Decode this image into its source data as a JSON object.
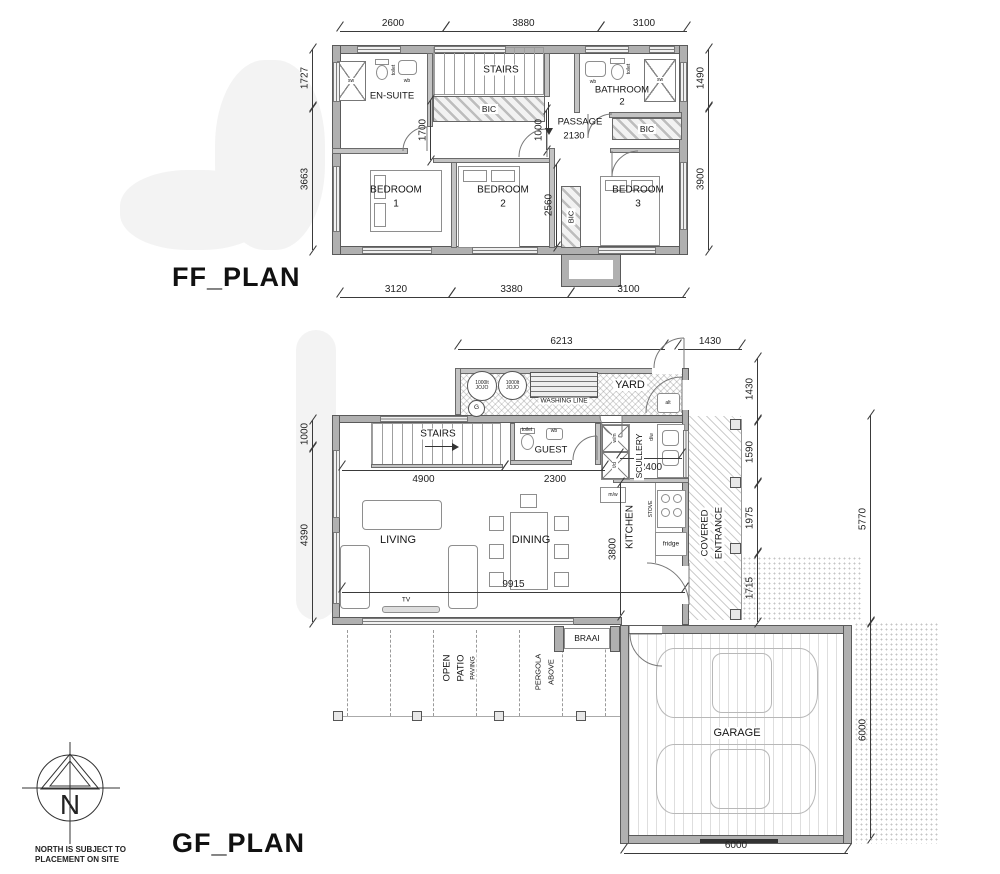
{
  "north": {
    "letter": "N",
    "note1": "NORTH IS SUBJECT TO",
    "note2": "PLACEMENT ON SITE"
  },
  "ff": {
    "title": "FF_PLAN",
    "dims": {
      "top": [
        "2600",
        "3880",
        "3100"
      ],
      "bottom": [
        "3120",
        "3380",
        "3100"
      ],
      "left": [
        "1727",
        "3663"
      ],
      "right": [
        "1490",
        "3900"
      ],
      "internal": {
        "bic": "1700",
        "passage": "1000",
        "bed2": "2560",
        "passage_w": "2130"
      }
    },
    "rooms": {
      "ensuite": "EN-SUITE",
      "stairs": "STAIRS",
      "bathroom": "BATHROOM",
      "bathroom_no": "2",
      "passage": "PASSAGE",
      "bedroom": "BEDROOM",
      "no1": "1",
      "no2": "2",
      "no3": "3",
      "bic": "BIC"
    },
    "fixtures": {
      "sw": "sw",
      "wb": "wb",
      "toilet": "toilet"
    }
  },
  "gf": {
    "title": "GF_PLAN",
    "dims": {
      "top": [
        "6213",
        "1430"
      ],
      "left": [
        "1000",
        "4390"
      ],
      "right_inner": [
        "1430",
        "1590",
        "1975",
        "1715"
      ],
      "right_outer": [
        "5770",
        "6000"
      ],
      "bottom": [
        "6000"
      ],
      "internal": {
        "stairs": "4900",
        "guest": "2300",
        "scullery": "2400",
        "kitchen": "3800",
        "living": "9915"
      }
    },
    "rooms": {
      "yard": "YARD",
      "washing_line": "WASHING LINE",
      "stairs": "STAIRS",
      "guest": "GUEST",
      "scullery": "SCULLERY",
      "kitchen": "KITCHEN",
      "covered": "COVERED",
      "entrance": "ENTRANCE",
      "living": "LIVING",
      "dining": "DINING",
      "open": "OPEN",
      "patio": "PATIO",
      "paving": "PAVING",
      "pergola": "PERGOLA",
      "above": "ABOVE",
      "braai": "BRAAI",
      "garage": "GARAGE"
    },
    "fixtures": {
      "jojo_cap": "1000lt",
      "jojo": "JOJO",
      "geyser": "G",
      "alt": "alt",
      "toilet": "toilet",
      "wb": "wb",
      "wm": "w/m",
      "td": "t/d",
      "mw": "m/w",
      "dw": "d/w",
      "stove": "STOVE",
      "fridge": "fridge",
      "tv": "TV"
    }
  }
}
